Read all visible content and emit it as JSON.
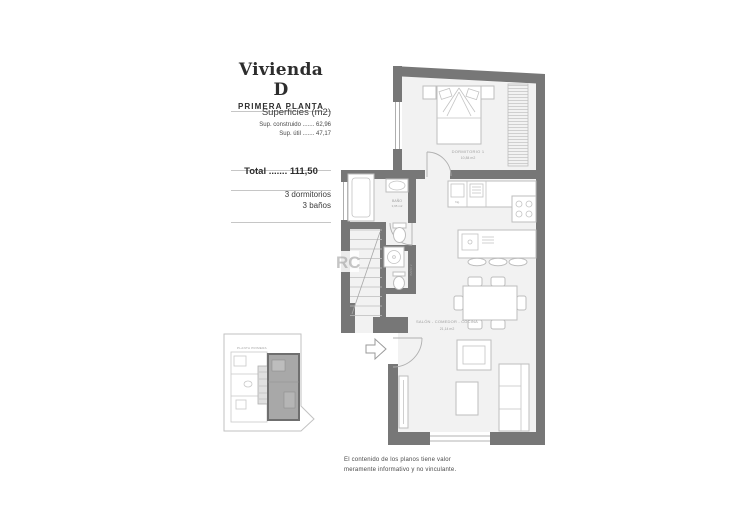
{
  "panel": {
    "title": "Vivienda D",
    "subtitle": "PRIMERA PLANTA",
    "surfaces_heading": "Superficies (m2)",
    "surface_lines": [
      "Sup. construido ....... 62,96",
      "Sup. útil ....... 47,17"
    ],
    "total_line": "Total ....... 111,50",
    "features": [
      "3 dormitorios",
      "3 baños"
    ]
  },
  "plan_labels": {
    "bedroom": "DORMITORIO 1",
    "bedroom_area": "10,84 m2",
    "bath": "BAÑO",
    "bath_area": "3,95 m2",
    "bath2_vertical": "BAÑO 2",
    "living": "SALÓN - COMEDOR - COCINA",
    "living_area": "21,14 m2",
    "fridge": "frig.",
    "watermark": "RC"
  },
  "inset": {
    "caption": "PLANTA PRIMERA"
  },
  "disclaimer": "El contenido de los planos tiene valor\nmeramente informativo y no vinculante.",
  "colors": {
    "wall": "#777777",
    "floor": "#f2f2f2",
    "furniture": "#bdbdbd",
    "label": "#a0a0a0"
  }
}
